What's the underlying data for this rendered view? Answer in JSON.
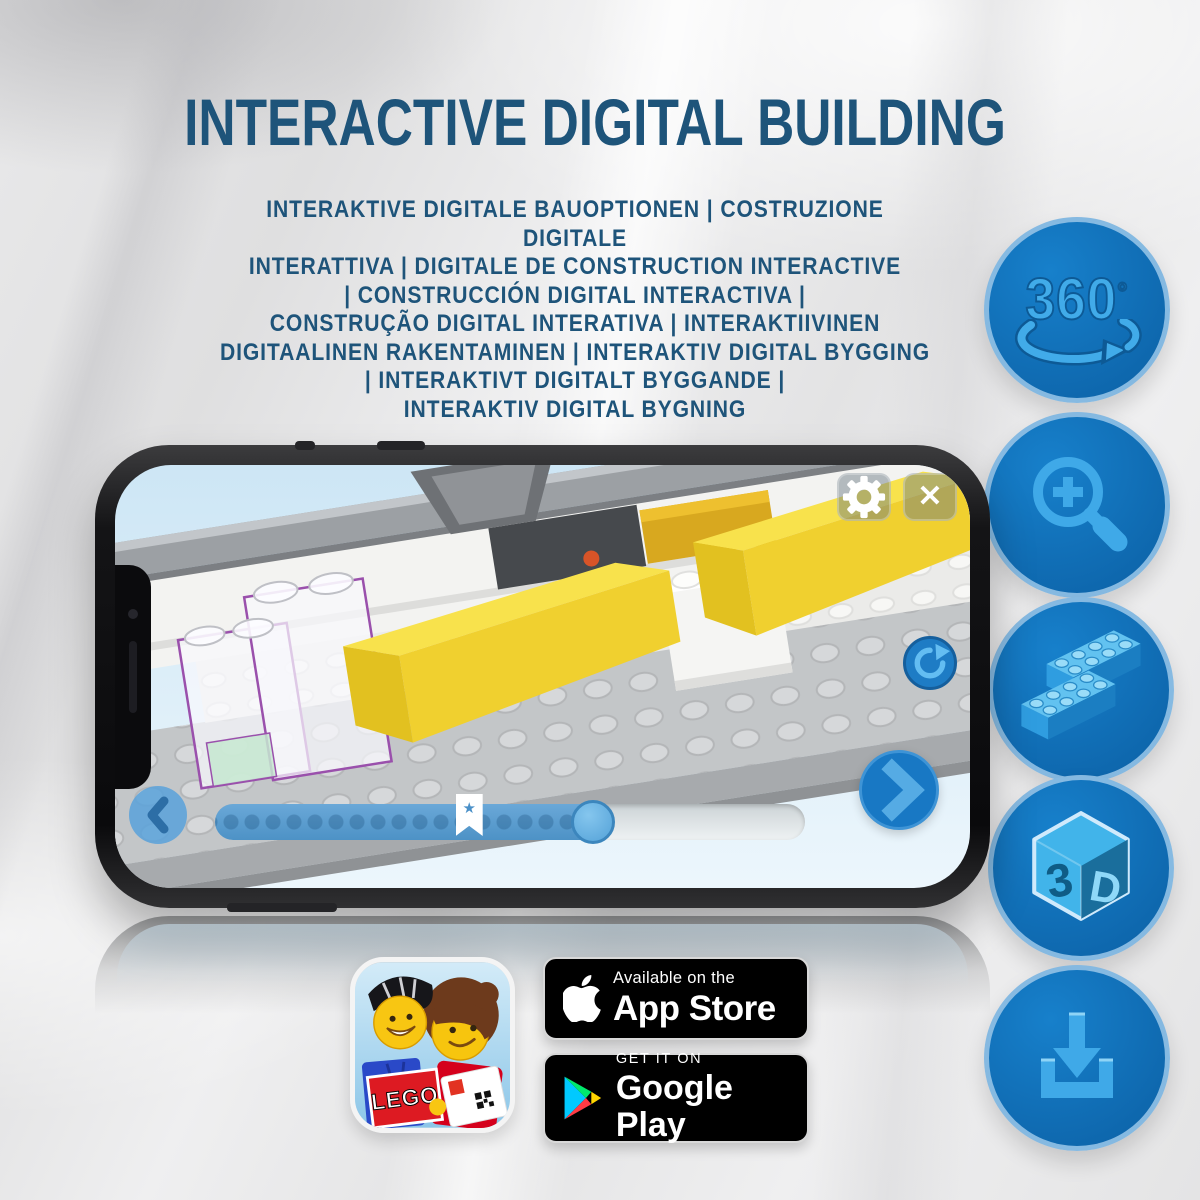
{
  "header": {
    "title": "INTERACTIVE DIGITAL BUILDING",
    "subtitle_lines": [
      "INTERAKTIVE DIGITALE BAUOPTIONEN | COSTRUZIONE DIGITALE",
      "INTERATTIVA | DIGITALE DE CONSTRUCTION INTERACTIVE",
      "| CONSTRUCCIÓN DIGITAL INTERACTIVA |",
      "CONSTRUÇÃO DIGITAL INTERATIVA | INTERAKTIIVINEN",
      "DIGITAALINEN RAKENTAMINEN | INTERAKTIV DIGITAL BYGGING",
      "| INTERAKTIVT DIGITALT BYGGANDE |",
      "INTERAKTIV DIGITAL BYGNING"
    ]
  },
  "feature_icons": {
    "rotation360": {
      "label": "360",
      "degree": "°",
      "icon": "360-rotation-arrow"
    },
    "zoom_in": {
      "icon": "magnifier-plus"
    },
    "bricks": {
      "icon": "stacked-lego-bricks"
    },
    "cube3d": {
      "left": "3",
      "right": "D",
      "icon": "3d-cube"
    },
    "download": {
      "icon": "download-arrow-tray"
    }
  },
  "phone_app": {
    "close_glyph": "✕",
    "bookmark_star": "★",
    "icons": {
      "settings": "gear",
      "close": "x",
      "rotate_view": "circular-arrow",
      "previous": "chevron-left",
      "next": "chevron-right"
    },
    "progress": {
      "fill_percent": 64,
      "bookmark_percent": 43
    }
  },
  "badges": {
    "lego_app": {
      "logo_text": "LEGO"
    },
    "app_store": {
      "line1": "Available on the",
      "line2": "App Store"
    },
    "google_play": {
      "line1": "GET IT ON",
      "line2": "Google Play"
    }
  },
  "colors": {
    "title_blue": "#1E547A",
    "icon_circle_fill": "#1173BD",
    "icon_glyph_blue": "#3FA9E8",
    "nav_button_blue": "#1878C4",
    "brick_yellow": "#F3D93B",
    "translucent_outline_purple": "#9A50AC",
    "badge_black": "#000000"
  }
}
